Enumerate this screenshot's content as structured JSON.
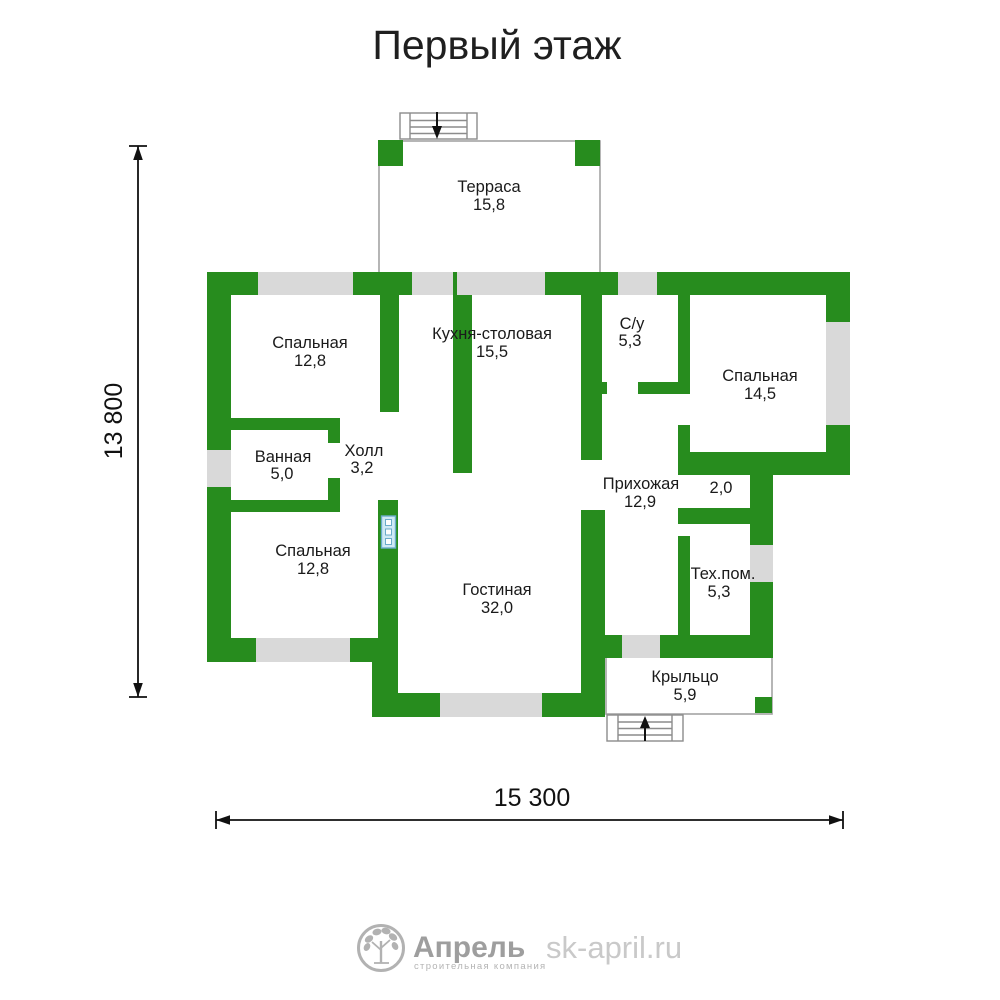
{
  "title": "Первый этаж",
  "colors": {
    "wall": "#278c1e",
    "window": "#d9d9d9",
    "outline": "#a3a3a3",
    "text": "#1a1a1a",
    "radiator_fill": "#cfe9f5",
    "radiator_border": "#6aaccb",
    "logo_gray": "#9e9e9e",
    "website_gray": "#c9c9c9"
  },
  "rooms": [
    {
      "name": "Терраса",
      "area": "15,8"
    },
    {
      "name": "Спальная",
      "area": "12,8"
    },
    {
      "name": "Кухня-столовая",
      "area": "15,5"
    },
    {
      "name": "С/у",
      "area": "5,3"
    },
    {
      "name": "Спальная",
      "area": "14,5"
    },
    {
      "name": "Ванная",
      "area": "5,0"
    },
    {
      "name": "Холл",
      "area": "3,2"
    },
    {
      "name": "Прихожая",
      "area": "12,9"
    },
    {
      "name": "",
      "area": "2,0"
    },
    {
      "name": "Спальная",
      "area": "12,8"
    },
    {
      "name": "Гостиная",
      "area": "32,0"
    },
    {
      "name": "Тех.пом.",
      "area": "5,3"
    },
    {
      "name": "Крыльцо",
      "area": "5,9"
    }
  ],
  "dimensions": {
    "height_mm": "13 800",
    "width_mm": "15 300"
  },
  "footer": {
    "brand": "Апрель",
    "tagline": "строительная компания",
    "website": "sk-april.ru"
  }
}
